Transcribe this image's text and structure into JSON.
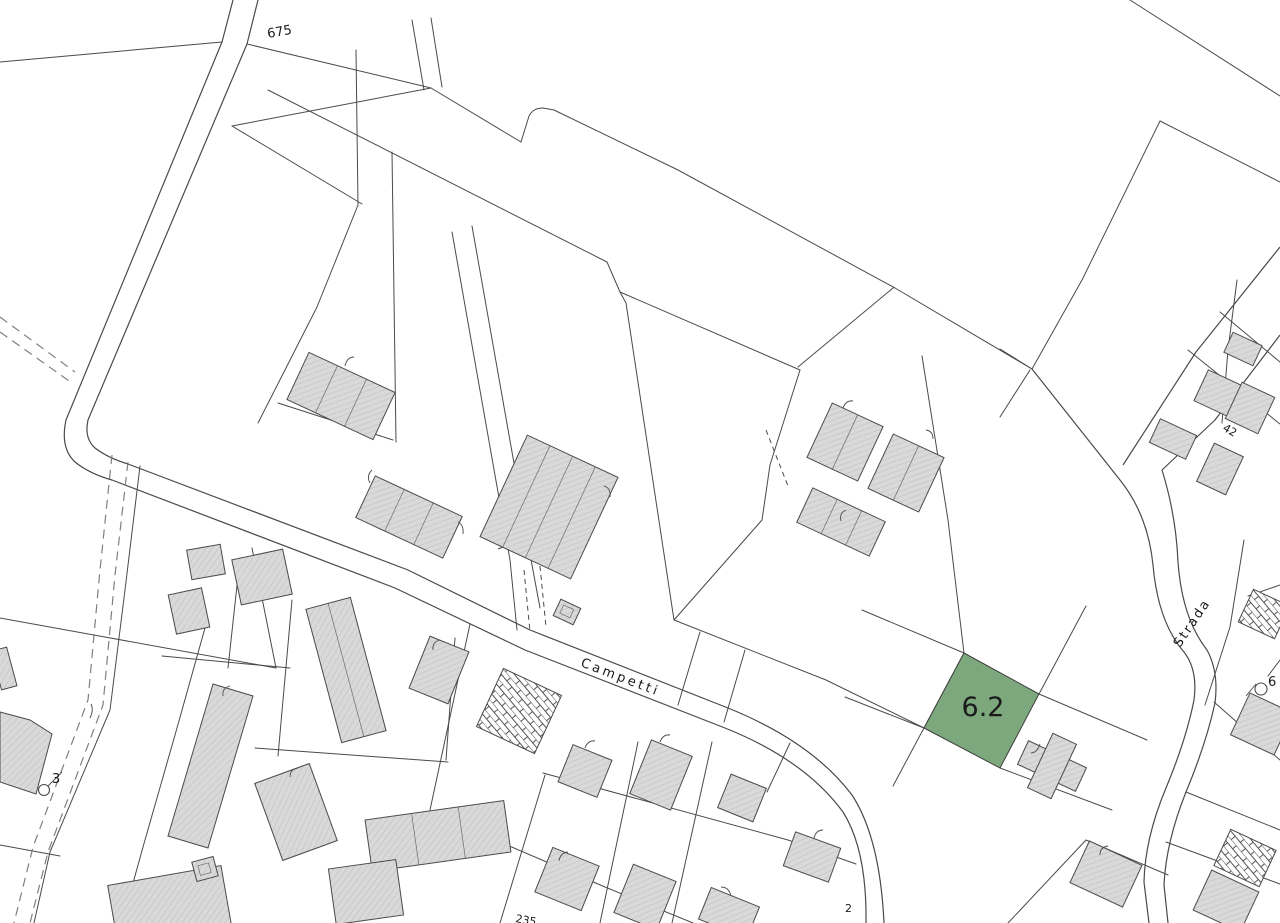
{
  "map": {
    "kind": "cadastral-parcel-map",
    "labels": {
      "parcel_675": "675",
      "street_campetti": "Campetti",
      "street_strada": "Strada",
      "survey_point_left": "3",
      "survey_point_right": "6",
      "parcel_42": "42",
      "parcel_235": "235",
      "parcel_2": "2"
    },
    "highlighted_parcel": {
      "label": "6.2",
      "fill": "#7da87d"
    },
    "colors": {
      "line": "#4a4a4a",
      "building_fill": "#d9d9d9",
      "building_hatch": "#bdbdbd",
      "brick_line": "#555555",
      "green_fill": "#7da87d",
      "green_stroke": "#3f3f3f",
      "dashed": "#7f7f7f",
      "text": "#1a1a1a",
      "bg": "#ffffff"
    }
  }
}
